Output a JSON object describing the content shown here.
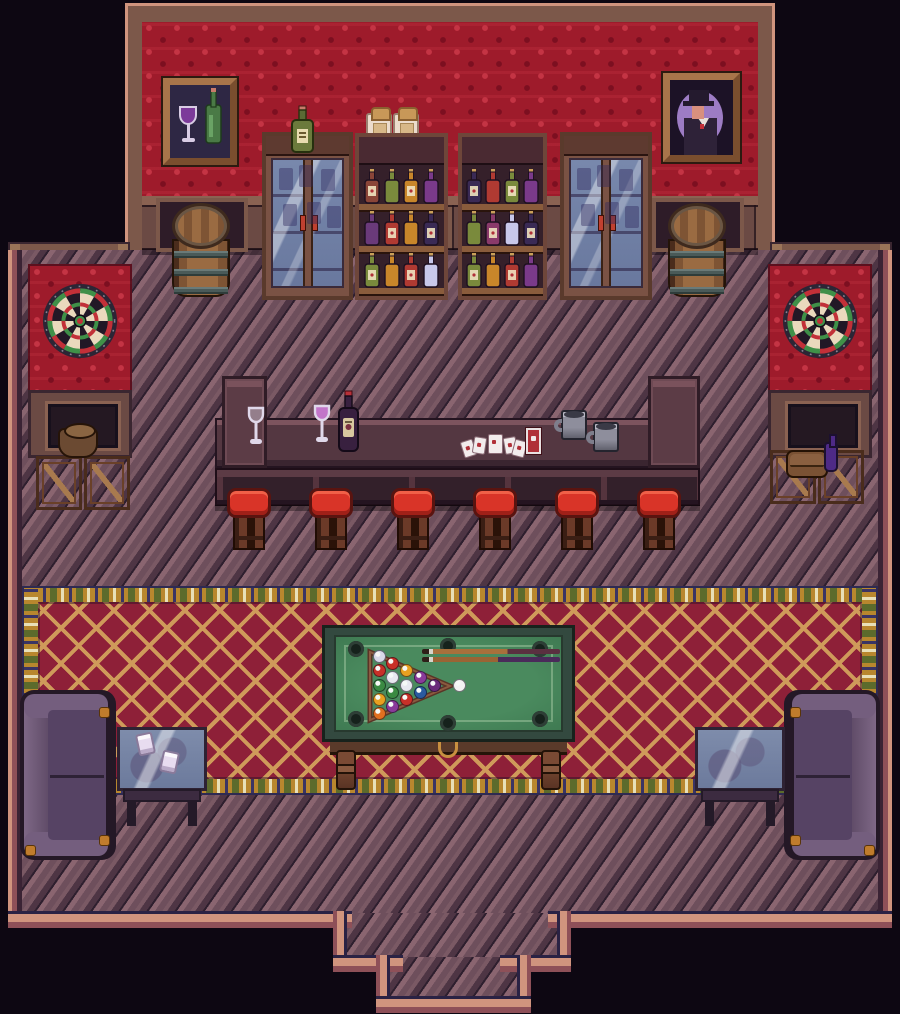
{
  "scene": {
    "description": "Top-down pixel-art saloon game room: red damask wallpaper wall with liquor shelves, glass cabinets, framed pictures and barrels; two dartboards on side wings; long bar counter with wine glasses, wine bottle, playing cards, card deck and two steins; six red stools; large crimson lattice carpet with a billiards table, racked balls and two cues; two purple couches with glass side tables; stepped exit doorway at the bottom."
  },
  "palette": {
    "background": "#0d0712",
    "wallpaper": "#9e1b2b",
    "wallpaper_light": "#c43444",
    "wallpaper_dark": "#7c0f20",
    "wood_trim": "#7c584a",
    "wood_trim_light": "#9a7458",
    "wood_dark": "#3a2630",
    "wainscot": "#6b4a44",
    "wainscot_rail": "#8a6252",
    "floor": "#6e4f5c",
    "floor_light": "#8a6570",
    "floor_dark": "#4e3544",
    "floor_seam": "#2e1f2e",
    "trim_salmon": "#d0947e",
    "trim_mauve": "#8e5058",
    "trim_navy": "#2a2244",
    "counter_top": "#543741",
    "counter_rail": "#5c3b45",
    "stool_cushion": "#d93428",
    "stool_wood": "#6b3a28",
    "carpet_field": "#8e2038",
    "carpet_lattice": "#cf9a5a",
    "carpet_gold": "#b8872e",
    "carpet_green": "#5c6b2c",
    "carpet_cream": "#e8e0b8",
    "carpet_outline": "#2e2a52",
    "felt": "#3f7a52",
    "felt_rail": "#9cc29c",
    "table_frame": "#33493f",
    "couch": "#675270",
    "couch_dark": "#241826",
    "couch_gold": "#c07c2c",
    "card_red": "#b03038",
    "dart_cream": "#ead9bd",
    "dart_black": "#221826",
    "dart_red": "#c23038",
    "dart_green": "#3f9048"
  },
  "decor": {
    "left_painting": "wine glass and green bottle still-life",
    "right_painting": "portrait of a man in a top hat",
    "dartboard_count": 2,
    "barrel_count": 2,
    "jar_count": 2
  },
  "shelves": {
    "unit_count": 2,
    "unit1_rows": [
      [
        "#8a4538",
        "#7a8a3c",
        "#c8862a",
        "#7a3a8a"
      ],
      [
        "#6a3a7a",
        "#b03a32",
        "#c8862a",
        "#3a2a55"
      ],
      [
        "#7a8a3c",
        "#c8862a",
        "#b03a32",
        "#c8c8ea"
      ]
    ],
    "unit2_rows": [
      [
        "#3a2a55",
        "#b03a32",
        "#7a8a3c",
        "#7a3a8a"
      ],
      [
        "#7a8a3c",
        "#8a3a6a",
        "#c8c8ea",
        "#3a2a55"
      ],
      [
        "#7a8a3c",
        "#c8862a",
        "#b03a32",
        "#7a3a8a"
      ]
    ]
  },
  "bar": {
    "stool_count": 6,
    "items": [
      "empty wine glass",
      "filled wine glass",
      "wine bottle",
      "scattered playing cards",
      "card deck",
      "pewter stein",
      "pewter stein"
    ]
  },
  "billiards": {
    "rack_ball_colors": [
      "#d8d8e8",
      "#c83028",
      "#3a8a42",
      "#e8a020",
      "#e07020",
      "#c83028",
      "#e8e8f0",
      "#3a8a42",
      "#8a3a9a",
      "#e8a020",
      "#e8e8f0",
      "#c83028",
      "#8a3a9a",
      "#2a5aa0",
      "#6a2a7a"
    ],
    "cue_ball_color": "#f2f2f2",
    "cue_count": 2,
    "pocket_count": 6
  },
  "lounge": {
    "couch_count": 2,
    "side_table_count": 2,
    "cups_on_left_table": 2
  },
  "storage": {
    "left_crates": 2,
    "right_crates": 2,
    "left_item": "basket",
    "right_items": [
      "satchel",
      "violet bottle"
    ]
  }
}
